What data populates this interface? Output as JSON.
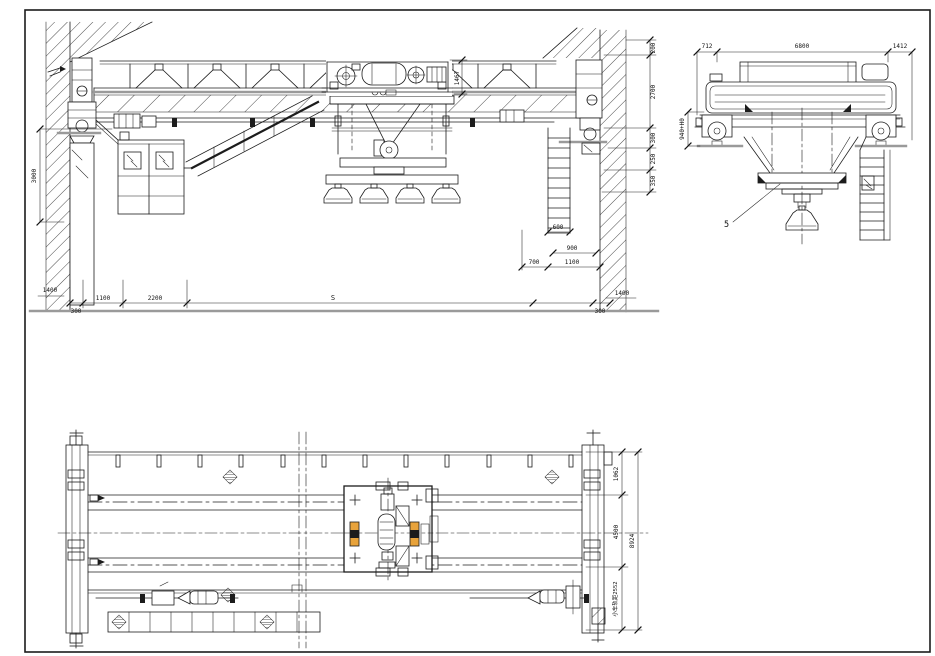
{
  "drawing": {
    "type": "overhead-crane-general-arrangement",
    "colors": {
      "line": "#1c1c1c",
      "gray_rail": "#9a9a9a",
      "accent_orange": "#e8a33b",
      "background": "#ffffff"
    },
    "front": {
      "height_3000": "3000",
      "trolley_1467": "1467",
      "right_chain": {
        "r200": "200",
        "r2700": "2700",
        "r300": "300",
        "r250": "250",
        "r350": "350"
      },
      "mid": {
        "d600": "600",
        "d900": "900",
        "d700": "700",
        "d1100": "1100"
      },
      "bottom": {
        "left_1400": "1400",
        "left_300": "300",
        "b1100": "1100",
        "b2200": "2200",
        "span": "S",
        "right_300": "300",
        "right_1400": "1400"
      }
    },
    "side": {
      "d712": "712",
      "d6800": "6800",
      "d1412": "1412",
      "h940": "940+H0",
      "item5": "5"
    },
    "plan": {
      "d1062": "1062",
      "d4500": "4500",
      "d8924": "8924",
      "gauge": "小车轨距2552"
    }
  }
}
